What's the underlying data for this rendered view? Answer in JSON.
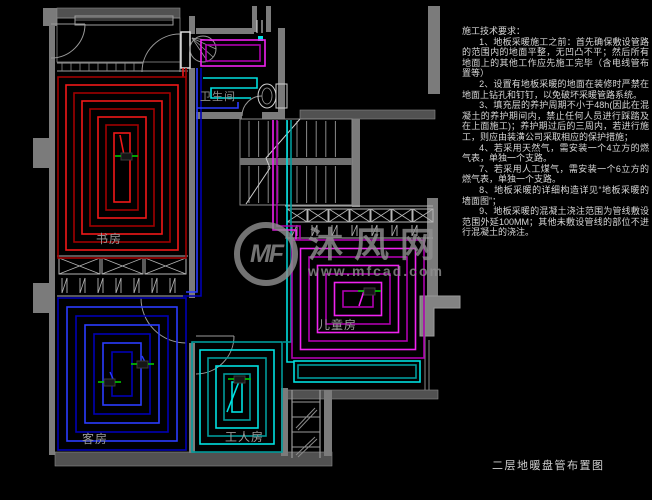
{
  "canvas": {
    "width": 652,
    "height": 500,
    "background": "#000000"
  },
  "drawing_title": "二层地暖盘管布置图",
  "watermark": {
    "logo": "MF",
    "name": "沐风网",
    "url": "www.mfcad.com",
    "color": "#909090"
  },
  "notes": {
    "title": "施工技术要求：",
    "items": [
      "1、地板采暖施工之前：首先确保敷设管路的范围内的地面平整，无凹凸不平；然后所有地面上的其他工作应先施工完毕（含电线管布置等）",
      "2、设置有地板采暖的地面在装修时严禁在地面上钻孔和钉钉，以免破坏采暖管路系统。",
      "3、填充层的养护周期不小于48h(因此在混凝土的养护期间内，禁止任何人员进行踩踏及在上面施工)；养护期过后的三周内，若进行施工，则应由装潢公司采取相应的保护措施；",
      "4、若采用天然气，需安装一个4立方的燃气表，单独一个支路。",
      "7、若采用人工煤气，需安装一个6立方的燃气表，单独一个支路。",
      "8、地板采暖的详细构造详见“地板采暖的墙面图”；",
      "9、地板采暖的混凝土浇注范围为管线敷设范围外延100MM；其他未敷设管线的部位不进行混凝土的浇注。"
    ]
  },
  "rooms": [
    {
      "id": "study",
      "label": "书房",
      "coil": "red"
    },
    {
      "id": "guest",
      "label": "客房",
      "coil": "blue"
    },
    {
      "id": "bath",
      "label": "卫生间",
      "coil": "mixed"
    },
    {
      "id": "kids",
      "label": "儿童房",
      "coil": "magenta"
    },
    {
      "id": "worker",
      "label": "工人房",
      "coil": "cyan"
    }
  ],
  "palette": {
    "wall": "#7b7b7b",
    "wall_dark": "#515151",
    "wall_light": "#8f8f8f",
    "line": "#9e9e9e",
    "line_bright": "#d9d9d9",
    "red_dark": "#a00000",
    "red": "#f01818",
    "blue_dark": "#0000b4",
    "blue": "#2a3cff",
    "magenta_dark": "#ae00ae",
    "magenta": "#f022f0",
    "cyan_dark": "#009a9a",
    "cyan": "#00e0e0",
    "green": "#00c800",
    "teal_marker": "#00e5e5",
    "white": "#e8e8e8"
  }
}
